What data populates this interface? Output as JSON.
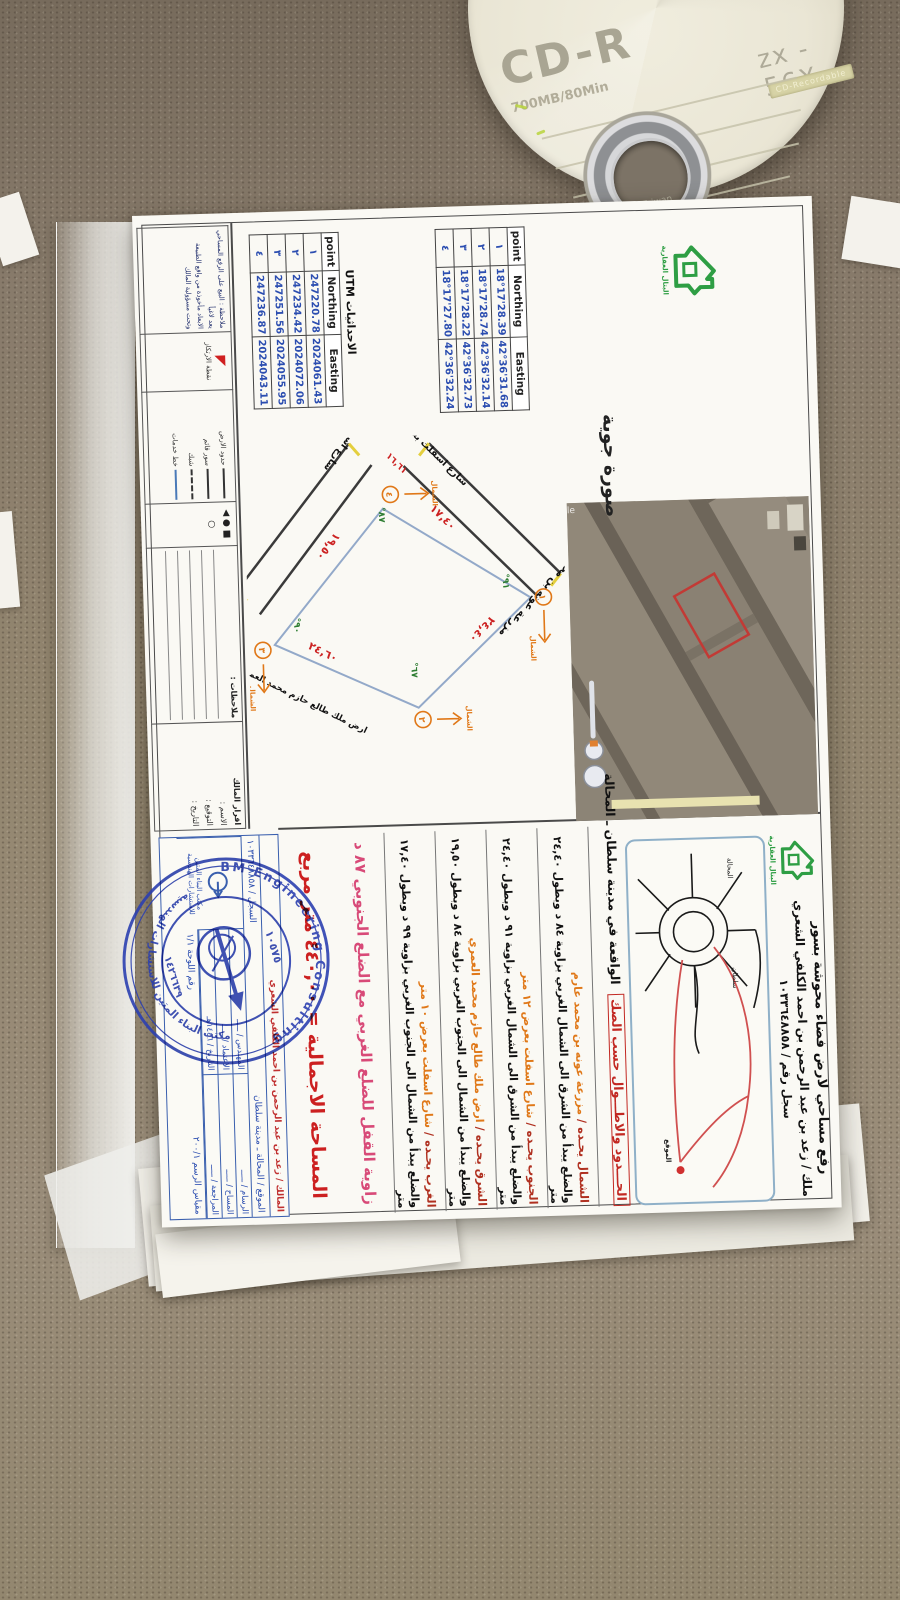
{
  "scene": {
    "background": "couch fabric",
    "fabric_color": "#8e8171"
  },
  "cd": {
    "label": "CD-R",
    "capacity": "700MB/80Min",
    "speed": "zx - 56X",
    "band": "CD-Recordable",
    "made_in": "Made in Taiwan"
  },
  "document": {
    "logo_caption": "البتال العقارية",
    "header": {
      "line1": "رفع مساحي لارض فضاء محوشة بسور",
      "line2": "ملك / زعد بن عبد الرحمن بن احمد الكلفي الشعري",
      "line3": "سجل رقم / ١٠٣٣٦٤٨٨٥٨"
    },
    "aerial": {
      "caption": "صورة جوية",
      "watermark": "Google"
    },
    "tables": {
      "geo": {
        "headers": [
          "point",
          "Northing",
          "Easting"
        ],
        "rows": [
          [
            "١",
            "18°17'28.39",
            "42°36'31.68"
          ],
          [
            "٢",
            "18°17'28.74",
            "42°36'32.14"
          ],
          [
            "٣",
            "18°17'28.22",
            "42°36'32.73"
          ],
          [
            "٤",
            "18°17'27.80",
            "42°36'32.24"
          ]
        ]
      },
      "utm_label": "الاحداثيات UTM",
      "utm": {
        "headers": [
          "point",
          "Northing",
          "Easting"
        ],
        "rows": [
          [
            "١",
            "247220.78",
            "2024061.43"
          ],
          [
            "٢",
            "247234.42",
            "2024072.06"
          ],
          [
            "٣",
            "247251.56",
            "2024055.95"
          ],
          [
            "٤",
            "247236.87",
            "2024043.11"
          ]
        ]
      }
    },
    "section_header": {
      "red": "الحـــدود والاطـــوال حسب الصك",
      "black": "الواقعة في مدينة سلطان ـ المحالة"
    },
    "boundaries": [
      {
        "label": "الشمال يحـده /",
        "name": "مزرعة عونه بن محمد عارم",
        "desc": "والضلع يبدأ من الشرق الى الشمال الغربي بزاوية ٨٤ د وبطول ٢٤,٤٠ متر"
      },
      {
        "label": "الجنوب يحـده /",
        "name": "شارع اسفلت بعرض ١٢ متر",
        "desc": "والضلع يبدأ من الشرق الى الشمال الغربي بزاوية ٩١ د وبطول ٢٤,٤٠ متر"
      },
      {
        "label": "الشرق يحـده /",
        "name": "ارض ملك طالع حازم محمد العمري",
        "desc": "والضلع يبدأ من الشمال الى الجنوب الغربي بزاوية ٨٤ د وبطول ١٩,٥٠ متر"
      },
      {
        "label": "الغرب يحـده /",
        "name": "شارع اسفلت بعرض ١٠ متر",
        "desc": "والضلع يبدأ من الشمال الى الجنوب الغربي بزاوية ٩٩ د وبطول ١٧,٤٠ متر"
      }
    ],
    "closure_row": "زاوية القفل للضلع الغربي مع الضلع الجنوبي ٨٧ د",
    "area_row": "المساحة الاجمالية  =  ٤٤٠,٠٠ متر مربع",
    "sketch": {
      "street_west": "شارع اسفلت بعرض ١٠ متر",
      "street_south": "شارع اسفلت بعرض ١٢ متر",
      "neighbor_north": "مزرعة عونه بن محمد عارم",
      "neighbor_east": "ارض ملك طالع حازم محمد العمري",
      "dims": {
        "west": "١٧,٤٠",
        "north": "٢٤,٤٠",
        "south": "١٩,٥٠",
        "east": "٢٤,٦٠",
        "extra": "١٦,٦١"
      },
      "angles": {
        "p1": "٩١°",
        "p2": "٦٧°",
        "p3": "٩٠°",
        "p4": "٨٧°"
      },
      "points": {
        "p1": "١",
        "p2": "٢",
        "p3": "٣",
        "p4": "٤"
      },
      "north_label": "الشمال"
    },
    "map": {
      "labels": [
        "المحالة",
        "سلطان"
      ],
      "site_label": "الموقع"
    },
    "legend": {
      "box1_title": "اقرار المالك",
      "box1_fields": [
        "الاسم :",
        "التوقيع :",
        "التاريخ :"
      ],
      "box2_title": "ملاحظات :",
      "rows": [
        {
          "style": "solid",
          "label": "حدود الارض"
        },
        {
          "style": "cross",
          "label": "سور قائم"
        },
        {
          "style": "dashed",
          "label": "شبك"
        },
        {
          "style": "blue",
          "label": "خط خدمات"
        }
      ],
      "symbols": "■ ● ◀ ○",
      "benchmark": "نقطة الارتكاز",
      "notes_line1": "ملاحظة : البيع على الرفع المساحي يعد لاغياً",
      "notes_line2": "الابعاد مأخوذة من واقع الطبيعة وتحت مسؤولية المالك"
    },
    "title_block": {
      "row1": "المالك / زعد بن عبد الرحمن بن احمد الكلفي الشعري",
      "row2a": "الموقع / المحالة ـ مدينة سلطان",
      "row2b": "السجل / ١٠٣٣٦٤٨٨٥٨",
      "cells": [
        [
          "الرسام / ـــــ",
          "المساح / ـــــ",
          "المراجعة / ـــــ"
        ],
        [
          "المهندس / ـــــ",
          "الاعتماد / ـــــ",
          "التاريخ / ١٤٤٦هـ"
        ]
      ],
      "office_name": "مكتب البناء المتين للاستشارات الهندسية",
      "scale": "مقياس الرسم ٢٠٠/١",
      "sheet_no": "رقم اللوحة ١/١"
    },
    "stamp": {
      "arc_top": "BM Engineering Consulting",
      "arc_bottom": "مكتب البناء المتين للاستشارات الهندسية",
      "number": "١٠٥٧٥",
      "license": "١٤٢٦٦٣٩"
    }
  }
}
